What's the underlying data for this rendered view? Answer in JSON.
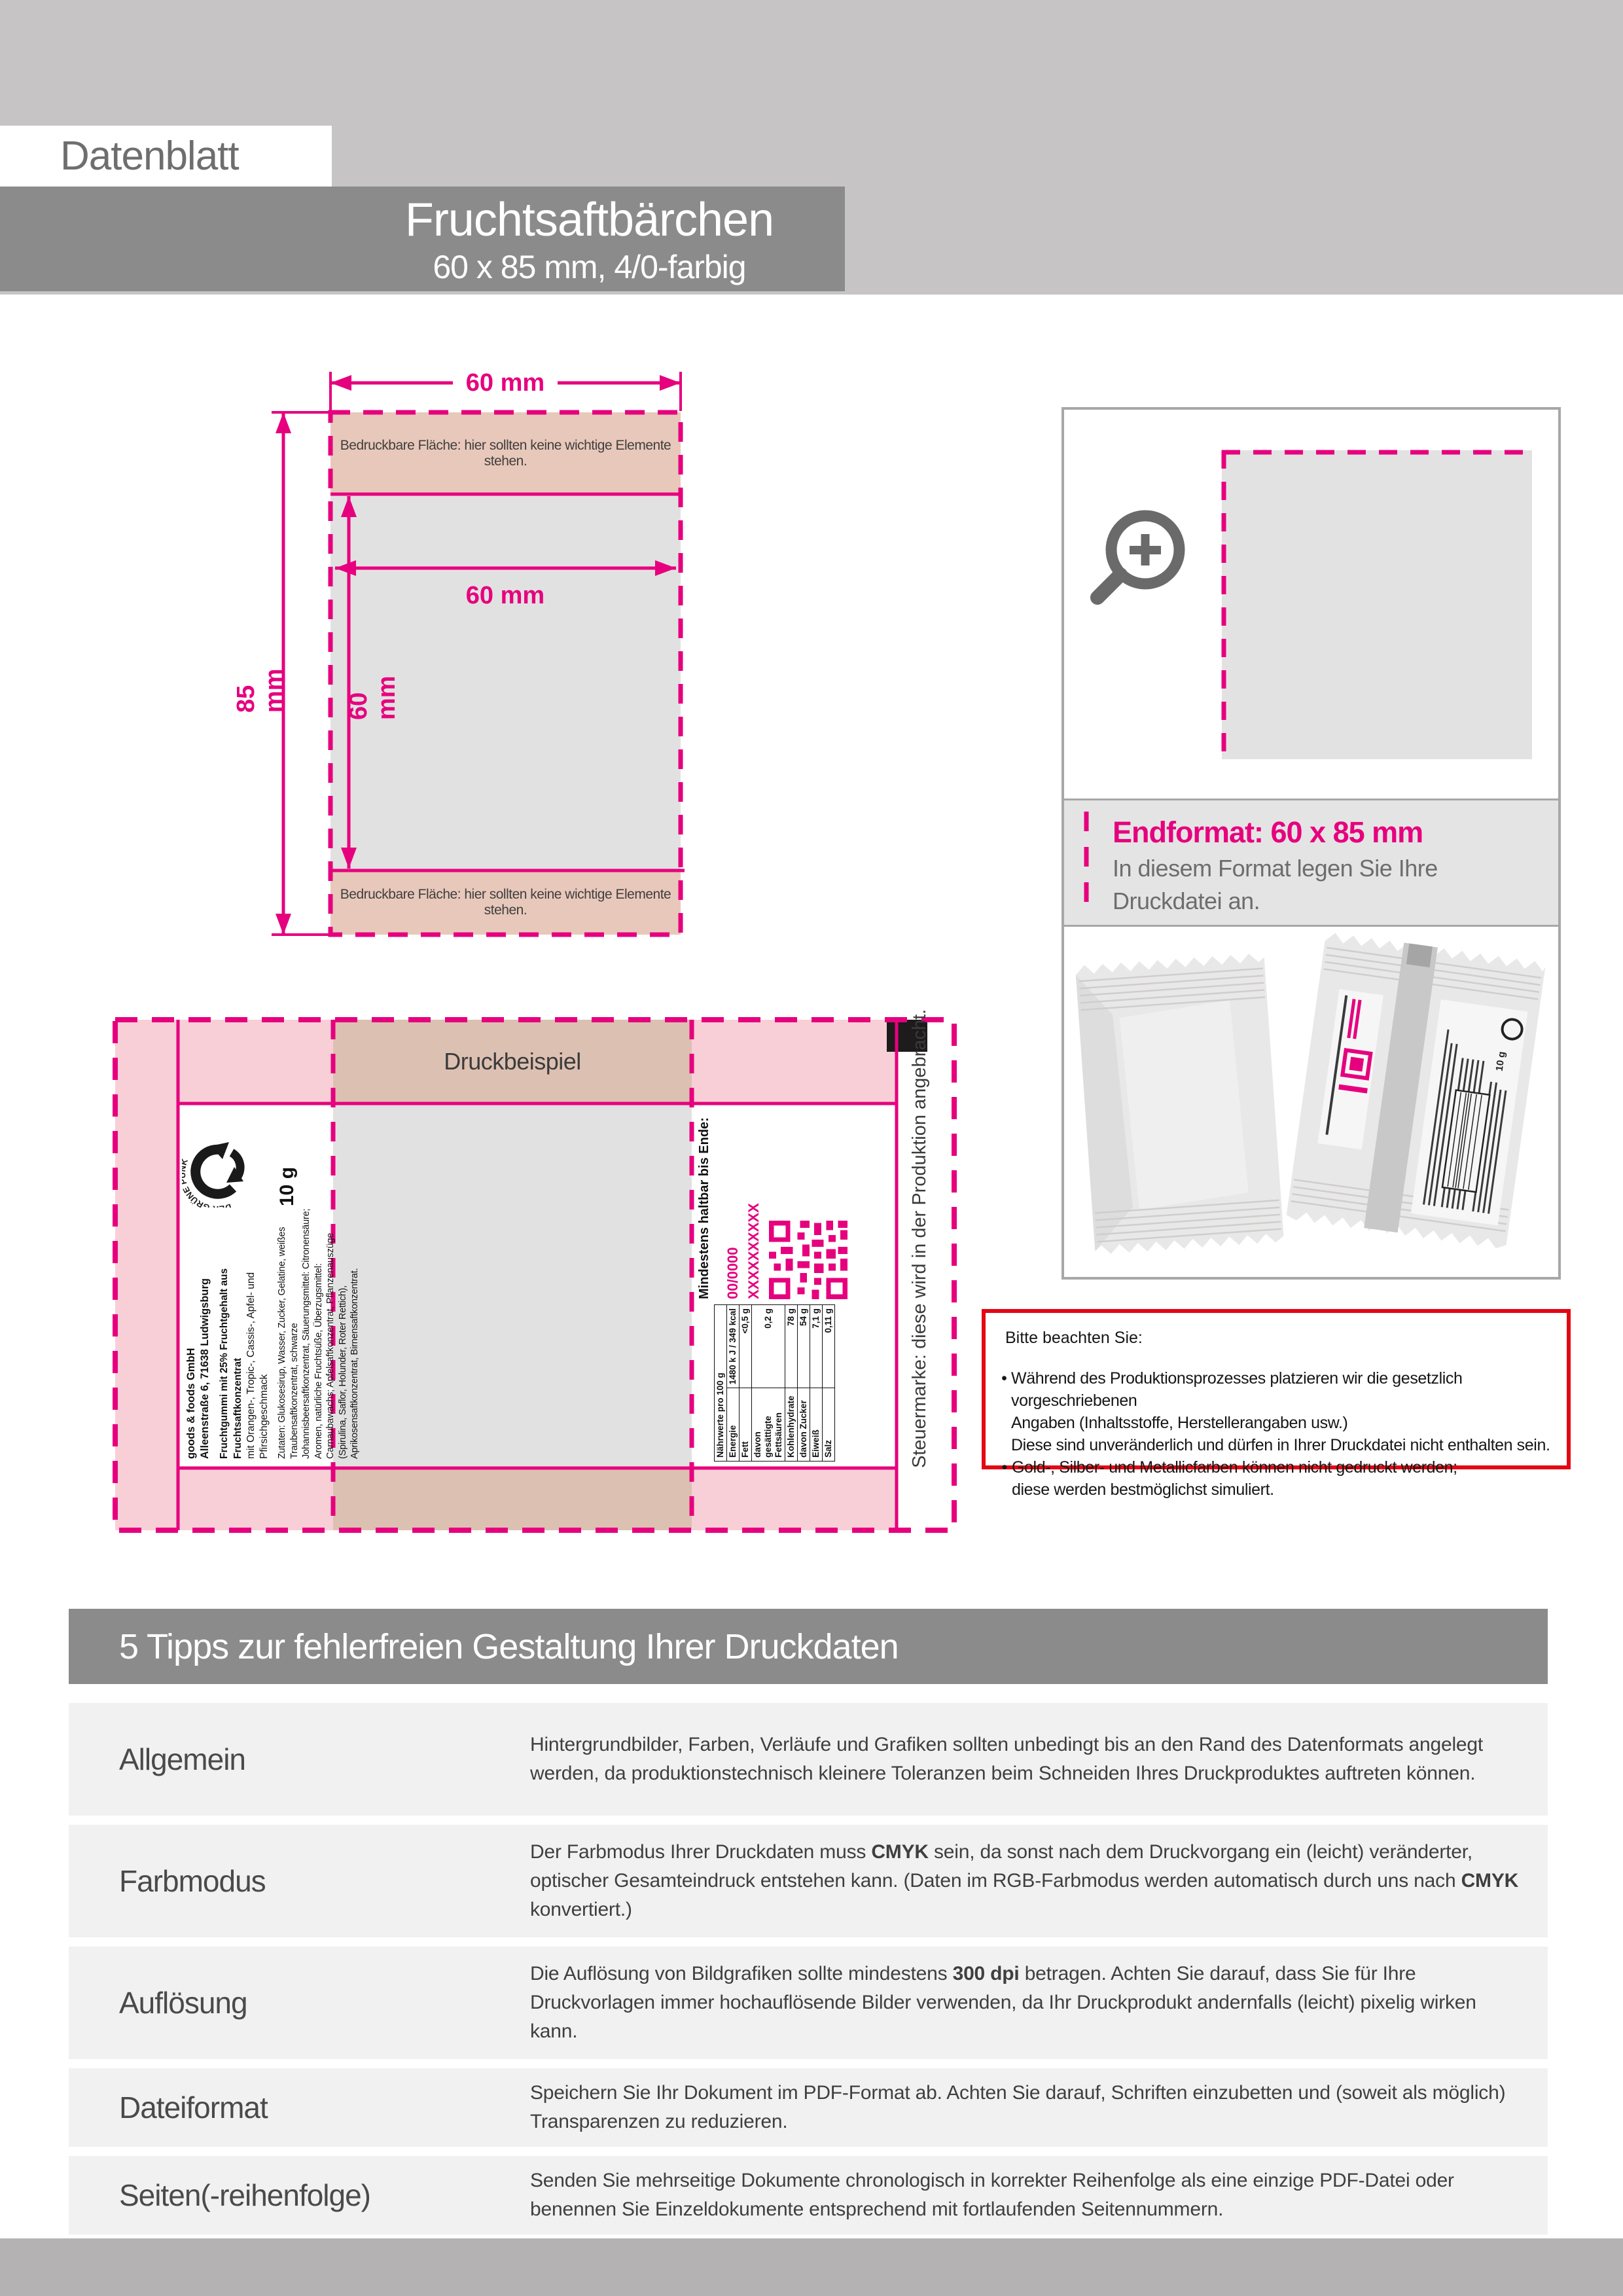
{
  "header": {
    "doc_label": "Datenblatt",
    "title": "Fruchtsaftbärchen",
    "subtitle": "60 x 85 mm, 4/0-farbig"
  },
  "colors": {
    "accent_magenta": "#e6007e",
    "notice_red": "#e30613",
    "banner_gray": "#8c8b8b",
    "light_gray_band": "#c6c4c5",
    "printable_salmon": "#e8c8ba",
    "layout_pink": "#f9cfd7",
    "print_area_gray": "#e2e1e1",
    "footer_gray": "#b4b2b3"
  },
  "front_diagram": {
    "width_label": "60 mm",
    "height_label": "85 mm",
    "inner_width_label": "60 mm",
    "inner_height_label": "60 mm",
    "printable_note_top": "Bedruckbare Fläche: hier sollten keine wichtige Elemente stehen.",
    "printable_note_bottom": "Bedruckbare Fläche: hier sollten keine wichtige Elemente stehen."
  },
  "endformat": {
    "title": "Endformat: 60 x 85 mm",
    "line1": "In diesem Format legen Sie Ihre",
    "line2": "Druckdatei an."
  },
  "druckbeispiel": {
    "title": "Druckbeispiel",
    "steuermarke_note": "Steuermarke: diese wird in der Produktion angebracht.",
    "label_left": {
      "company": "goods & foods GmbH",
      "address": "Alleenstraße 6, 71638 Ludwigsburg",
      "product_bold": "Fruchtgummi mit 25% Fruchtgehalt aus Fruchtsaftkonzentrat",
      "product_sub": "mit Orangen-, Tropic-, Cassis-, Apfel- und Pfirsichgeschmack",
      "ingredients": "Zutaten: Glukosesirup, Wasser, Zucker, Gelatine, weißes Traubensaftkonzentrat, schwarze Johannisbeersaftkonzentrat, Säuerungsmittel: Citronensäure; Aromen, natürliche Fruchtsüße, Überzugsmittel: Carnaubawachs; Apfelsaftkonzentrat, Pflanzenauszüge (Spirulina, Saflor, Holunder, Roter Rettich), Aprikosensaftkonzentrat, Birnensaftkonzentrat.",
      "weight": "10 g",
      "green_dot": "DER GRÜNE PUNKT"
    },
    "label_right": {
      "mhd": "Mindestens haltbar bis Ende:",
      "date_line1": "00/0000",
      "date_line2": "XXXXXXXXXX",
      "nutrition": {
        "header": "Nährwerte pro 100 g",
        "rows": [
          [
            "Energie",
            "1480 k J / 349 kcal"
          ],
          [
            "Fett",
            "<0,5 g"
          ],
          [
            "davon gesättigte Fettsäuren",
            "0,2 g"
          ],
          [
            "Kohlenhydrate",
            "78 g"
          ],
          [
            "davon Zucker",
            "54 g"
          ],
          [
            "Eiweiß",
            "7,1 g"
          ],
          [
            "Salz",
            "0,11 g"
          ]
        ]
      }
    }
  },
  "notice": {
    "title": "Bitte beachten Sie:",
    "bullets": [
      "Während des Produktionsprozesses platzieren wir die gesetzlich vorgeschriebenen\nAngaben (Inhaltsstoffe, Herstellerangaben usw.)\nDiese sind unveränderlich und dürfen in Ihrer Druckdatei nicht enthalten sein.",
      "Gold-, Silber- und Metallicfarben können nicht gedruckt werden;\ndiese werden bestmöglichst simuliert."
    ]
  },
  "tips": {
    "heading": "5 Tipps zur fehlerfreien Gestaltung Ihrer Druckdaten",
    "rows": [
      {
        "label": "Allgemein",
        "segments": [
          {
            "t": "Hintergrundbilder, Farben, Verläufe und Grafiken sollten unbedingt bis an den Rand des Datenformats angelegt werden, da produktionstechnisch kleinere Toleranzen beim Schneiden Ihres Druckproduktes auftreten können."
          }
        ]
      },
      {
        "label": "Farbmodus",
        "segments": [
          {
            "t": "Der Farbmodus Ihrer Druckdaten muss "
          },
          {
            "t": "CMYK",
            "b": true
          },
          {
            "t": " sein, da sonst nach dem Druckvorgang ein (leicht) veränderter, optischer Gesamteindruck entstehen kann. (Daten im RGB-Farbmodus werden automatisch durch uns nach "
          },
          {
            "t": "CMYK",
            "b": true
          },
          {
            "t": " konvertiert.)"
          }
        ]
      },
      {
        "label": "Auflösung",
        "segments": [
          {
            "t": "Die Auflösung von Bildgrafiken sollte mindestens "
          },
          {
            "t": "300 dpi",
            "b": true
          },
          {
            "t": " betragen. Achten Sie darauf, dass Sie für Ihre Druckvorlagen immer hochauflösende Bilder verwenden, da Ihr Druckprodukt andernfalls (leicht) pixelig wirken kann."
          }
        ]
      },
      {
        "label": "Dateiformat",
        "segments": [
          {
            "t": "Speichern Sie Ihr Dokument im PDF-Format ab. Achten Sie darauf, Schriften einzubetten und (soweit als möglich) Transparenzen zu reduzieren."
          }
        ]
      },
      {
        "label": "Seiten(-reihenfolge)",
        "segments": [
          {
            "t": "Senden Sie mehrseitige Dokumente chronologisch in korrekter Reihenfolge als eine einzige PDF-Datei oder benennen Sie Einzeldokumente entsprechend mit fortlaufenden Seitennummern."
          }
        ]
      }
    ]
  }
}
